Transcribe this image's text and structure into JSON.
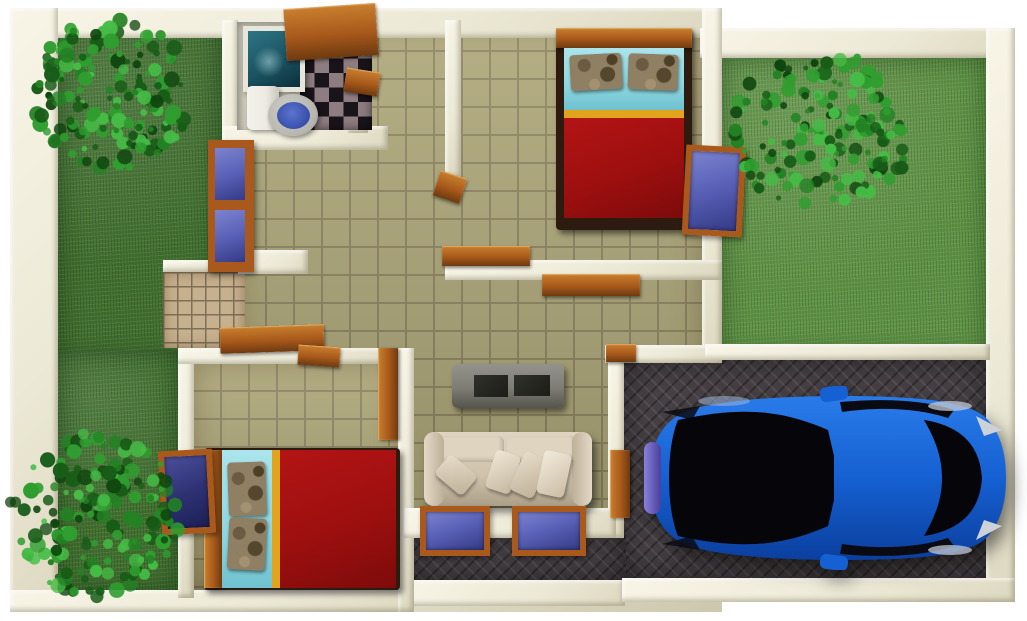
{
  "scene": {
    "type": "3d-rendered-house-floor-plan-top-view",
    "rooms": [
      "bathroom",
      "bedroom-top",
      "hallway",
      "living-room",
      "bedroom-bottom",
      "left-yard",
      "right-yard",
      "carport-driveway",
      "front-porch",
      "patio"
    ],
    "objects": [
      "tree",
      "toilet",
      "sink-basin",
      "checkerboard-floor",
      "double-bed",
      "pillows",
      "wardrobe-window",
      "wood-door",
      "wall-shelf",
      "tv-console",
      "sofa",
      "throw-pillows",
      "casement-window",
      "blue-car",
      "paver-driveway",
      "grass-lawn",
      "tile-floor"
    ],
    "colors": {
      "bg": "#ffffff",
      "wall_face": "#ece9d6",
      "wall_light": "#f8f5e7",
      "wall_dark": "#cdc8ad",
      "grass_left": "#41702f",
      "grass_right": "#5f9345",
      "tile": "#ada678",
      "grout": "#8d845f",
      "patio": "#c6b08e",
      "patio_grout": "#7f6f58",
      "checker_dark": "#19141a",
      "checker_light": "#8d7c80",
      "paving": "#474145",
      "wood": "#a8591b",
      "wood_light": "#c87f2e",
      "wood_dark": "#6e3a10",
      "bed_red": "#9d0f0f",
      "bed_cyan": "#8ed7e0",
      "bed_stripe": "#e2a41d",
      "camo": "#8f7f63",
      "sofa": "#cec2ac",
      "sofa_light": "#ded4c0",
      "tv_gray": "#7d7d75",
      "tv_dark": "#1d1d18",
      "glass": "#5a62b8",
      "glass_dark": "#2e3275",
      "car_blue": "#1560d2",
      "car_blue_dark": "#0b3f9e",
      "car_glass": "#06060a",
      "car_grille": "#6f63c8",
      "porcelain": "#eceae2",
      "seat_gray": "#b5b5ae",
      "bowl_blue": "#3e55b0",
      "sink_teal": "#19505e",
      "leaf_palette": [
        "#175c17",
        "#238223",
        "#2f9e2f",
        "#45bc45",
        "#0f460f"
      ]
    }
  }
}
